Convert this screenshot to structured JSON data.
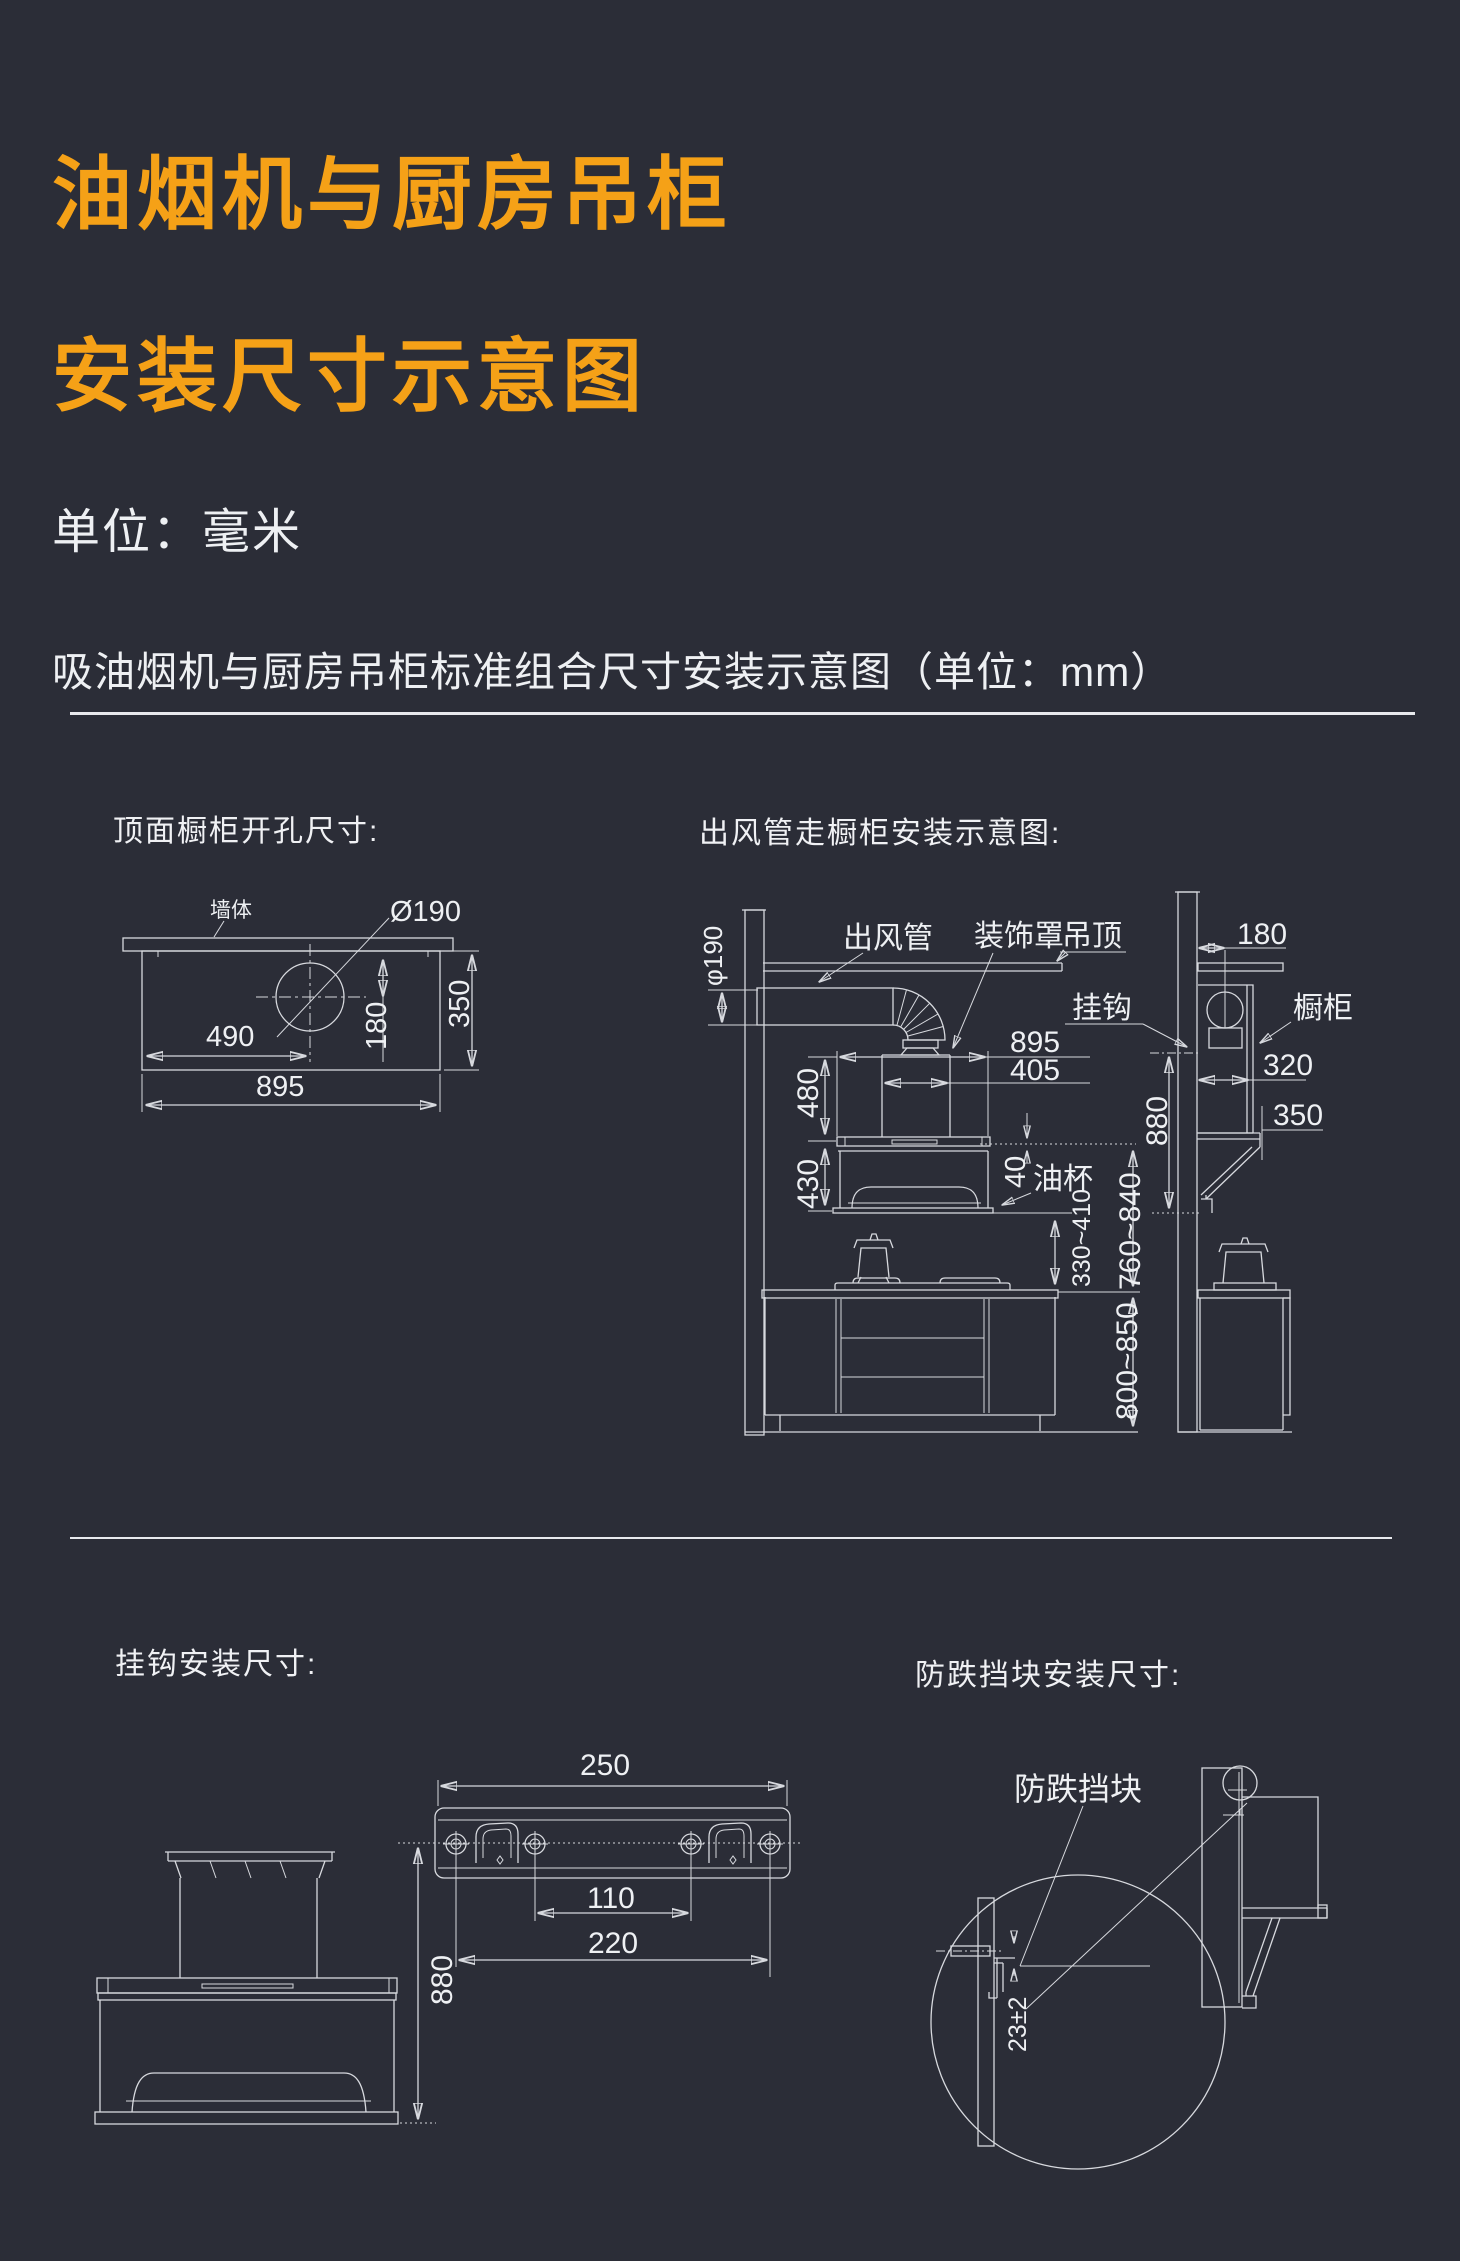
{
  "page": {
    "title_line1": "油烟机与厨房吊柜",
    "title_line2": "安装尺寸示意图",
    "unit_note": "单位：毫米",
    "subtitle": "吸油烟机与厨房吊柜标准组合尺寸安装示意图（单位：mm）"
  },
  "colors": {
    "background": "#2b2d37",
    "accent_orange": "#f5a117",
    "line": "#d7d9de",
    "text": "#eef0f3"
  },
  "cutout": {
    "title": "顶面橱柜开孔尺寸:",
    "wall_label": "墙体",
    "hole_label": "Ø190",
    "d490": "490",
    "d180": "180",
    "d350": "350",
    "d895": "895"
  },
  "duct": {
    "title": "出风管走橱柜安装示意图:",
    "duct_label": "出风管",
    "cover_label": "装饰罩",
    "ceiling_label": "吊顶",
    "hook_label": "挂钩",
    "cabinet_label": "橱柜",
    "oilcup_label": "油杯",
    "dia_label": "φ190",
    "d895": "895",
    "d405": "405",
    "d480": "480",
    "d430": "430",
    "d40": "40",
    "d330_410": "330~410",
    "d760_840": "760~840",
    "d880_side": "880",
    "d800_850": "800~850",
    "d180": "180",
    "d320": "320",
    "d350": "350"
  },
  "hook": {
    "title": "挂钩安装尺寸:",
    "d250": "250",
    "d110": "110",
    "d220": "220",
    "d880": "880"
  },
  "block": {
    "title": "防跌挡块安装尺寸:",
    "block_label": "防跌挡块",
    "d23": "23±2"
  }
}
